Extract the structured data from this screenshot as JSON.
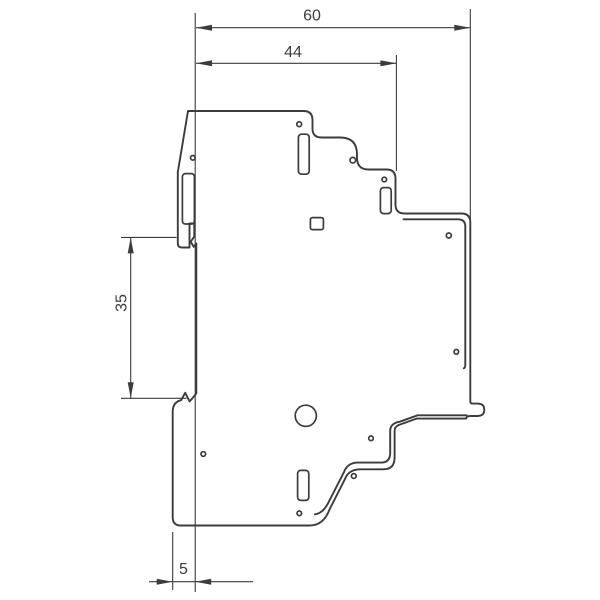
{
  "drawing": {
    "background": "#ffffff",
    "line_color": "#3c3c3c",
    "dimensions": {
      "overall_depth": {
        "label": "60"
      },
      "upper_depth": {
        "label": "44"
      },
      "rail_height": {
        "label": "35"
      },
      "rear_offset": {
        "label": "5"
      }
    }
  }
}
